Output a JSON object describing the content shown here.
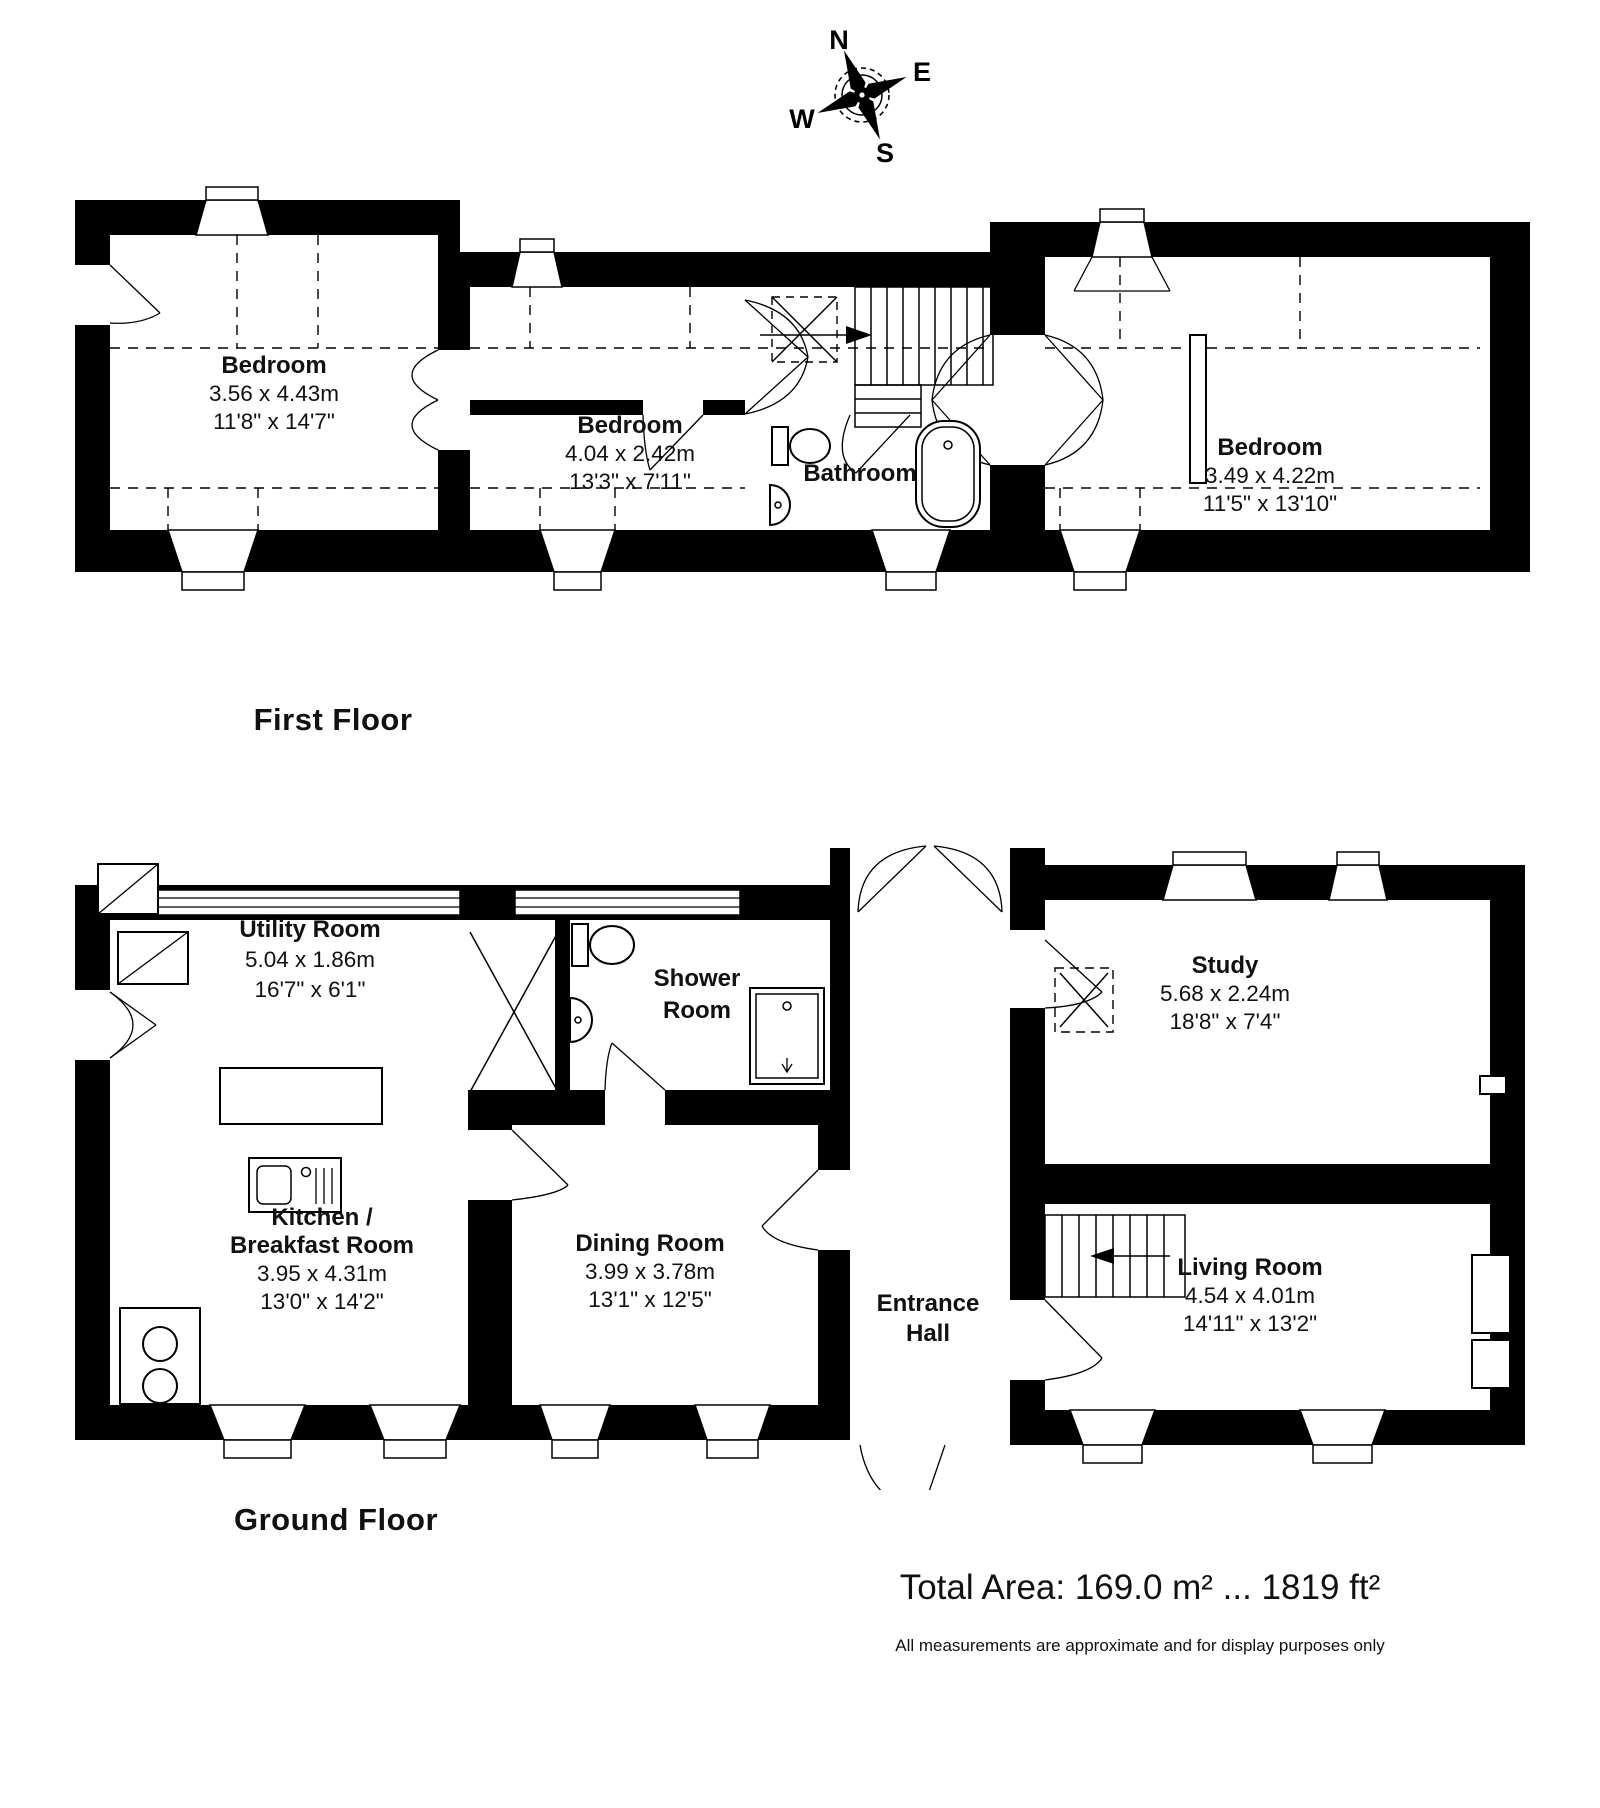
{
  "compass": {
    "north": "N",
    "east": "E",
    "south": "S",
    "west": "W"
  },
  "first_floor": {
    "title": "First Floor",
    "rooms": {
      "bedroom1": {
        "name": "Bedroom",
        "metric": "3.56 x 4.43m",
        "imperial": "11'8\" x 14'7\""
      },
      "bedroom2": {
        "name": "Bedroom",
        "metric": "4.04 x 2.42m",
        "imperial": "13'3\" x 7'11\""
      },
      "bathroom": {
        "name": "Bathroom"
      },
      "bedroom3": {
        "name": "Bedroom",
        "metric": "3.49 x 4.22m",
        "imperial": "11'5\" x 13'10\""
      }
    }
  },
  "ground_floor": {
    "title": "Ground Floor",
    "rooms": {
      "utility": {
        "name": "Utility Room",
        "metric": "5.04 x 1.86m",
        "imperial": "16'7\" x 6'1\""
      },
      "shower": {
        "name_line1": "Shower",
        "name_line2": "Room"
      },
      "study": {
        "name": "Study",
        "metric": "5.68 x 2.24m",
        "imperial": "18'8\" x 7'4\""
      },
      "kitchen": {
        "name_line1": "Kitchen /",
        "name_line2": "Breakfast Room",
        "metric": "3.95 x 4.31m",
        "imperial": "13'0\" x 14'2\""
      },
      "dining": {
        "name": "Dining Room",
        "metric": "3.99 x 3.78m",
        "imperial": "13'1\" x 12'5\""
      },
      "entrance": {
        "name_line1": "Entrance",
        "name_line2": "Hall"
      },
      "living": {
        "name": "Living Room",
        "metric": "4.54 x 4.01m",
        "imperial": "14'11\" x 13'2\""
      }
    }
  },
  "footer": {
    "total_area": "Total Area: 169.0 m² ... 1819 ft²",
    "disclaimer": "All measurements are approximate and for display purposes only"
  }
}
